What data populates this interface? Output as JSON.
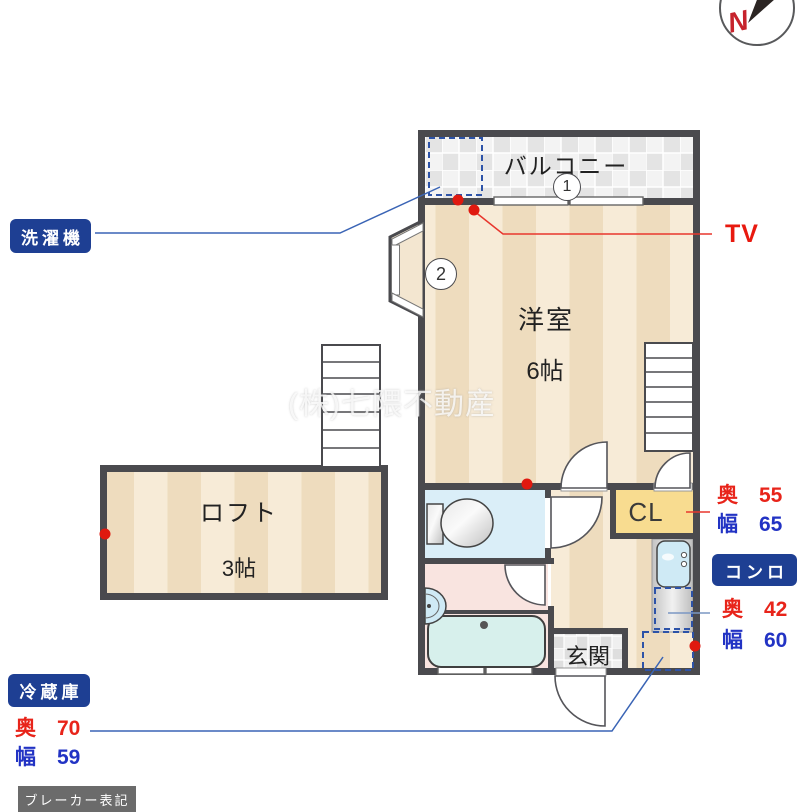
{
  "watermark": "(株)七隈不動産",
  "compass": {
    "letter": "N"
  },
  "rooms": {
    "balcony": {
      "name": "バルコニー",
      "number": "1"
    },
    "main": {
      "name": "洋室",
      "size": "6帖",
      "number": "2"
    },
    "loft": {
      "name": "ロフト",
      "size": "3帖"
    },
    "entrance": {
      "name": "玄関"
    },
    "closet": {
      "name": "CL"
    }
  },
  "tags": {
    "washer": "洗濯機",
    "tv": "TV",
    "stove": "コンロ",
    "fridge": "冷蔵庫",
    "breaker": "ブレーカー表記"
  },
  "measurements": {
    "closet": {
      "depth_label": "奥",
      "depth": "55",
      "width_label": "幅",
      "width": "65"
    },
    "stove": {
      "depth_label": "奥",
      "depth": "42",
      "width_label": "幅",
      "width": "60"
    },
    "fridge": {
      "depth_label": "奥",
      "depth": "70",
      "width_label": "幅",
      "width": "59"
    }
  },
  "icons": {
    "compass-icon": "circle with red N and black needle",
    "toilet-icon": "toilet plan symbol",
    "bathtub-icon": "bathtub plan symbol",
    "washbasin-icon": "half-round basin",
    "kitchen-sink-icon": "counter sink",
    "stairs-icon": "stair rungs",
    "door-arc-icon": "door swing arc",
    "placement-box-icon": "blue dashed appliance box",
    "marker-dot-icon": "red outlet dot"
  },
  "colors": {
    "wall": "#4a4a4e",
    "floor_light": "#f7ebd7",
    "floor_dark": "#eedcbe",
    "toilet_room": "#daeef8",
    "bathroom_pink": "#f9e4e0",
    "bathtub": "#d7f0ec",
    "closet_yellow": "#f8dc90",
    "tag_navy": "#1e3f93",
    "accent_red": "#e8241a",
    "accent_blue": "#2233c4",
    "pointer_blue": "#3a64b5",
    "marker_red": "#e0190f"
  }
}
